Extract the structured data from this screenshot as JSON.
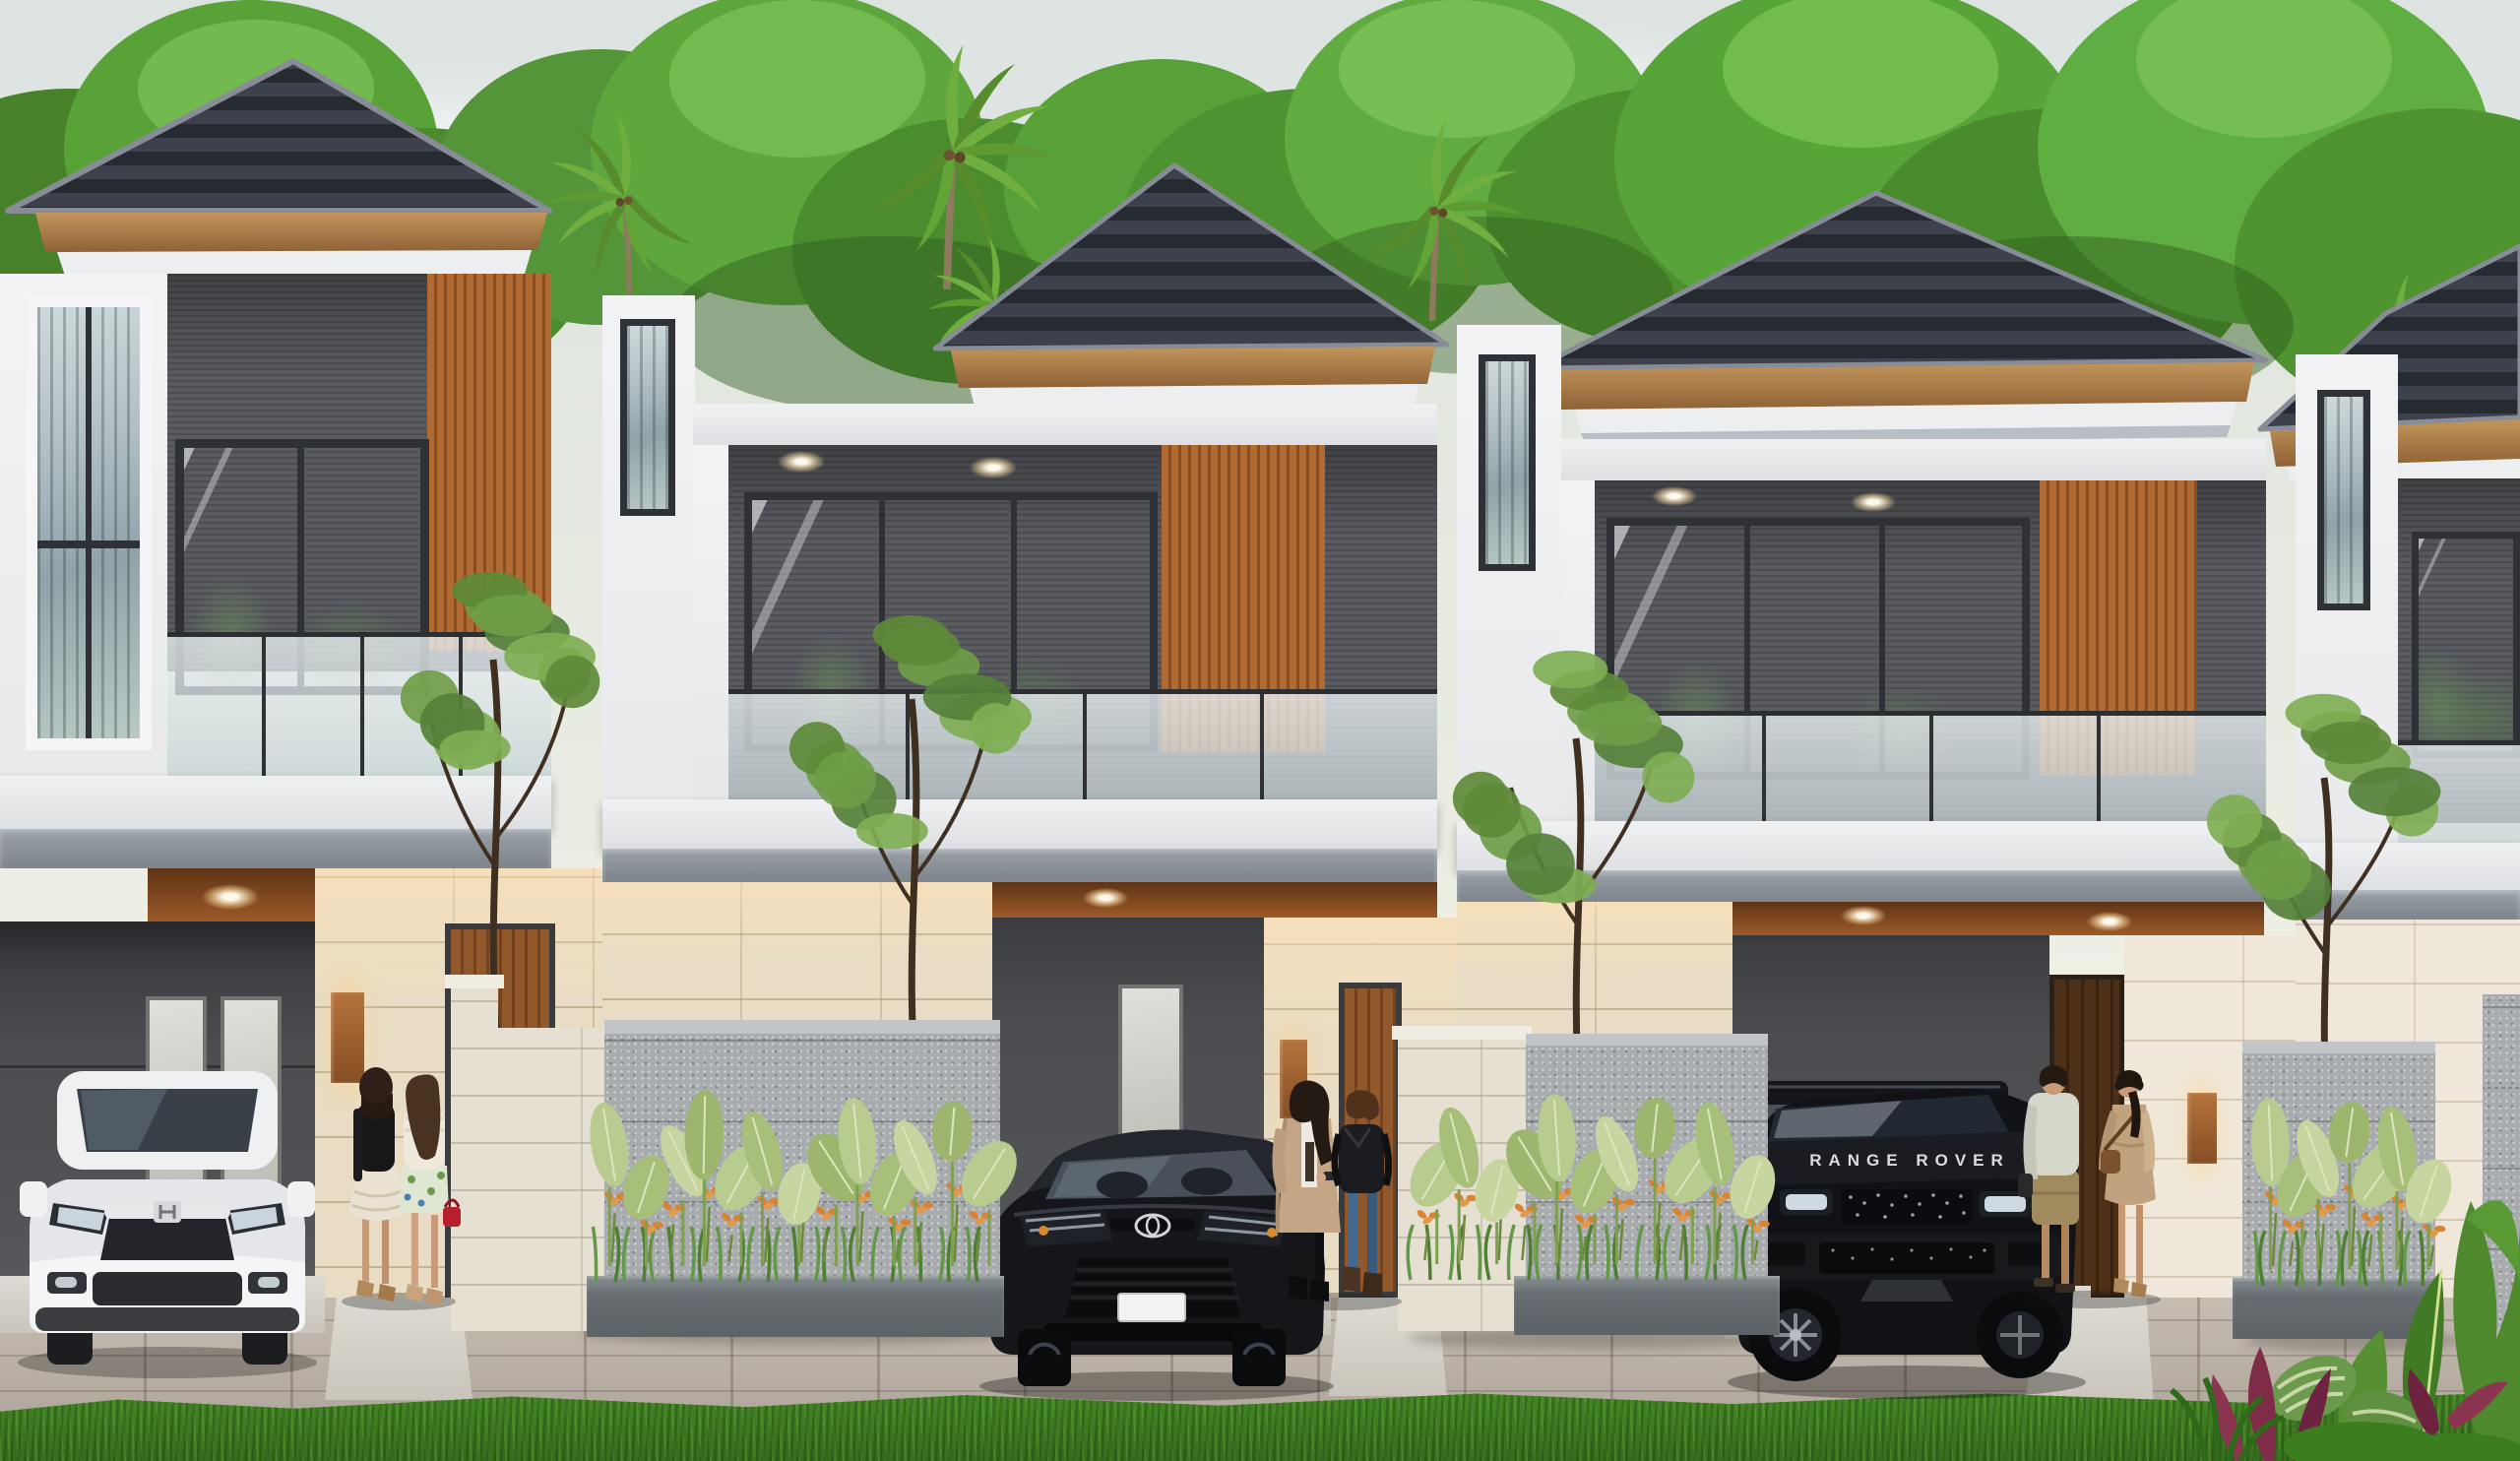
{
  "scene": {
    "type": "3D architectural exterior rendering",
    "subject": "Row of four modern two-storey tropical townhouses at dusk",
    "sky": "pale overcast dusk sky",
    "features": "dark hip tile roofs, wood fascia and slat accents, glass balcony railings, recessed warm downlights, cream stone ground walls, granite planter fences with orange flowering plants, paver driveways, green lawn"
  },
  "palette": {
    "sky_top": "#dce3e1",
    "sky_bottom": "#eef0e6",
    "roof_dark": "#262a31",
    "roof_stripe": "#3c414b",
    "wood_fascia": "#b6894f",
    "wood_slat": "#a9632f",
    "trim_white": "#f0f1f3",
    "wall_dark_panel": "#595b60",
    "stone_cream": "#e9dcc4",
    "granite_fence": "#a9acae",
    "leaf_light_green": "#b9cc90",
    "flower_orange": "#d98434",
    "lawn_green": "#3f7d22",
    "driveway_gray": "#b3aa9f",
    "car_white": "#f3f4f6",
    "car_black": "#121317"
  },
  "vehicles": {
    "left_suv": {
      "name": "white compact SUV with H emblem",
      "body_color": "#f3f4f6",
      "position": "left carport"
    },
    "middle_sedan": {
      "name": "black sedan with Toyota emblem",
      "body_color": "#121317",
      "plate": "blank white plate",
      "position": "middle carport"
    },
    "right_suv": {
      "name": "black luxury SUV",
      "hood_text": "RANGE ROVER",
      "body_color": "#101216",
      "position": "right carport"
    }
  },
  "people_groups": [
    {
      "name": "two-women-left",
      "detail": "woman in black top with cream ruffle skirt and woman in white lace top with floral shorts carrying red handbag, seen from behind beside white SUV"
    },
    {
      "name": "two-women-middle",
      "detail": "woman in long beige coat with black pants and woman in black leather jacket with blue jeans walking past black sedan"
    },
    {
      "name": "couple-right",
      "detail": "man in pale shirt and khaki shorts holding hands with woman in tan dress with shoulder bag, walking toward entry door"
    }
  ],
  "vegetation": {
    "background": "large green tree canopies and coconut palms behind the roofline",
    "yard_trees": "four slender ornamental trees in front of the facades",
    "planters": "broad light-green leaves with orange heliconia-like flowers and grasses along granite fences",
    "foreground_corner": "banana leaves, striped calathea, red cordyline and spiky shrubs at bottom right"
  }
}
